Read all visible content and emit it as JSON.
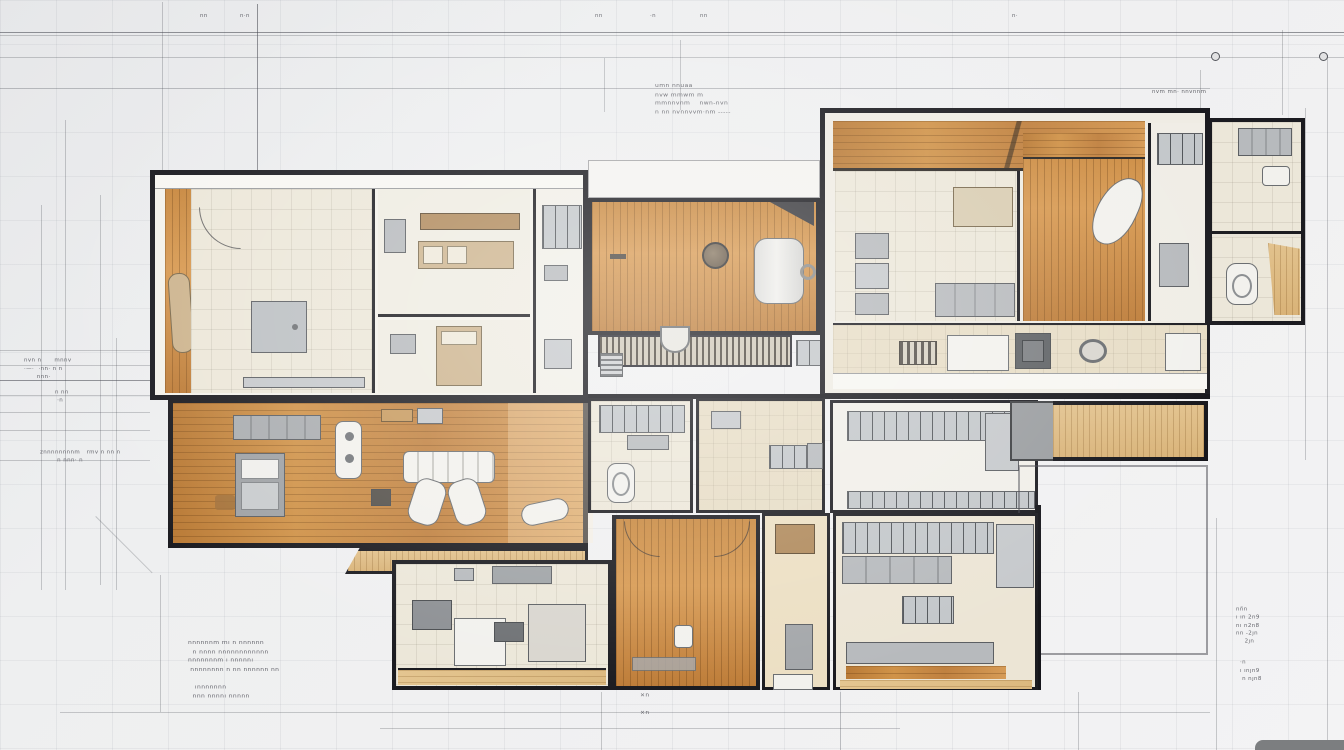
{
  "title": "architectural-floor-plan-sketch",
  "colors": {
    "paper": "#eef0f1",
    "wall": "#17171b",
    "wood": "#c8883f",
    "wood_pale": "#e0c08b",
    "tile": "#ece7d9",
    "furniture_gray": "#b7babd",
    "furniture_white": "#f2f1ed",
    "dimension_line": "#46484f"
  },
  "annotations": {
    "tick_1": "nn",
    "tick_2": "n·n",
    "tick_3": "nn",
    "tick_4": "·n",
    "tick_5": "nn",
    "tick_6": "n·",
    "top_center": "umn nnuaa\nnvw mmwm m\nmmnnvnm    nwn-nvn\nn nn nvnnvvm·nm -----",
    "top_right": "nvm mn· nnvnnm",
    "left_upper": "nvn n      mnnv\n·—·  ·nn· n n\n      nnn·",
    "left_mid": "znnnnnnnnm   rmv n nn n\n        n nnn· n",
    "left_lower": "n nn\n ·n",
    "bottom_left": "nnnnnnm mı n nnnnnn\n  n nnnn nnnnnnnnnnnn\nnnnnnnnm ı nnnnnı\n nnnnnnnn n nn nnnnnn nn\n\n   ınnnnnnn\n  nnn nnnnı nnnnn",
    "bottom_center": "×n\n\n×n",
    "bottom_right_upper": "nn̈n\nı ın 2n9\nnı n2n8\nnn -2ȷn\n    2ȷn",
    "bottom_right_lower": "·n\nı ınȷn9\n n nȷn8"
  }
}
